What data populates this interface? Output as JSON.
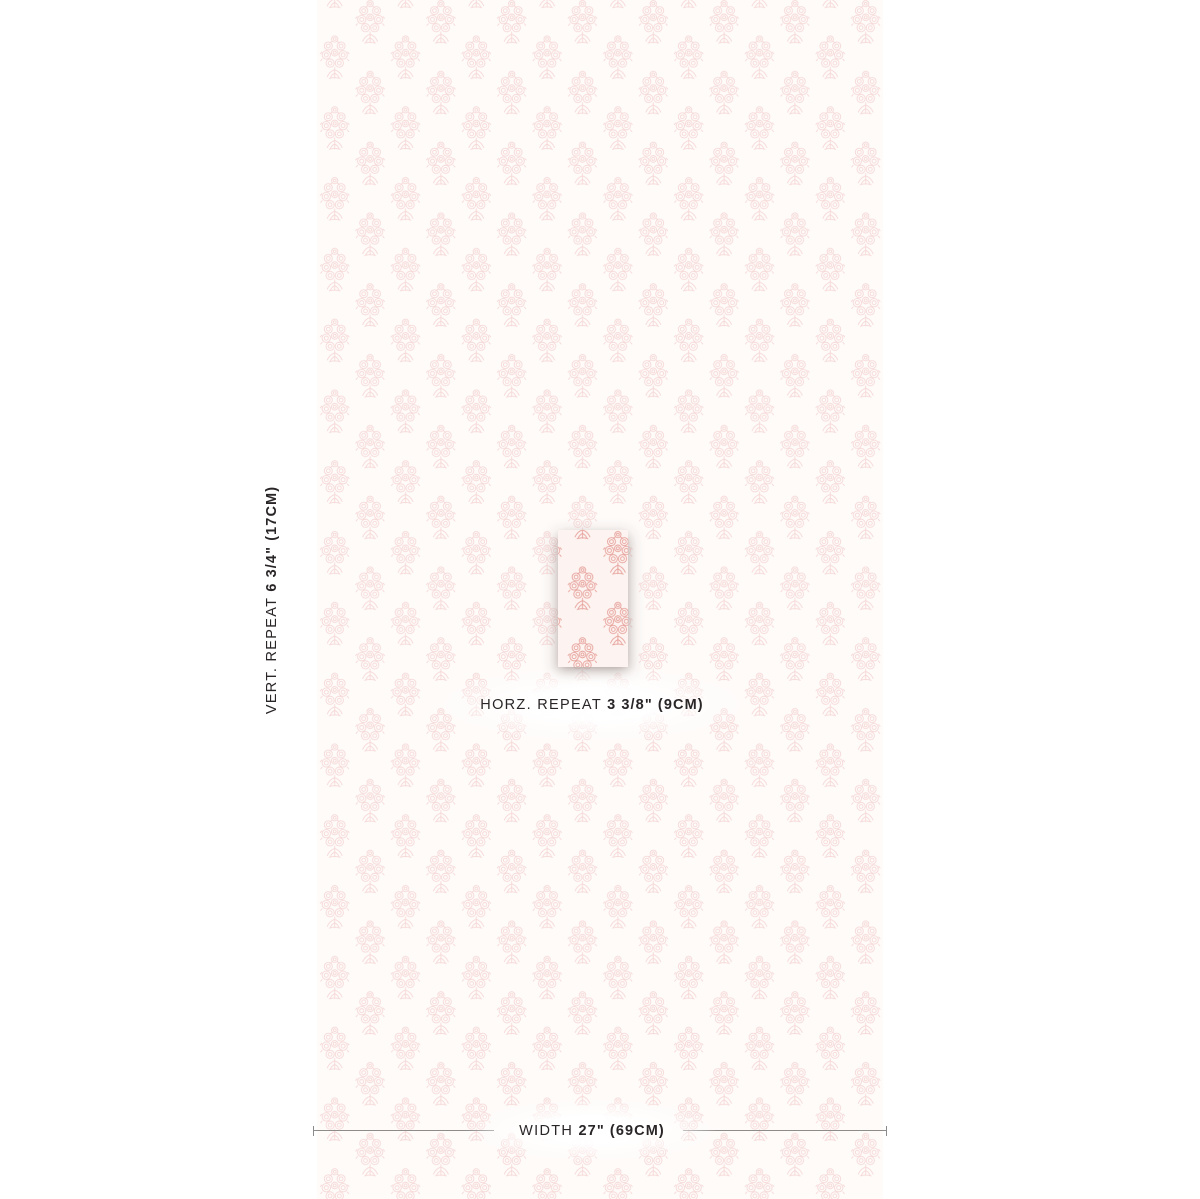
{
  "swatch": {
    "motif_name": "floral-bouquet-block-print",
    "background_color": "#fdf4f1",
    "motif_color": "#e6a09a",
    "fade_opacity": "0.6",
    "text_color": "#2a2627",
    "line_color": "#8e8b8b"
  },
  "dimensions": {
    "vertical_repeat": {
      "label": "VERT. REPEAT",
      "value": "6 3/4\" (17CM)"
    },
    "horizontal_repeat": {
      "label": "HORZ. REPEAT",
      "value": "3 3/8\" (9CM)"
    },
    "width": {
      "label": "WIDTH",
      "value": "27\" (69CM)"
    }
  }
}
